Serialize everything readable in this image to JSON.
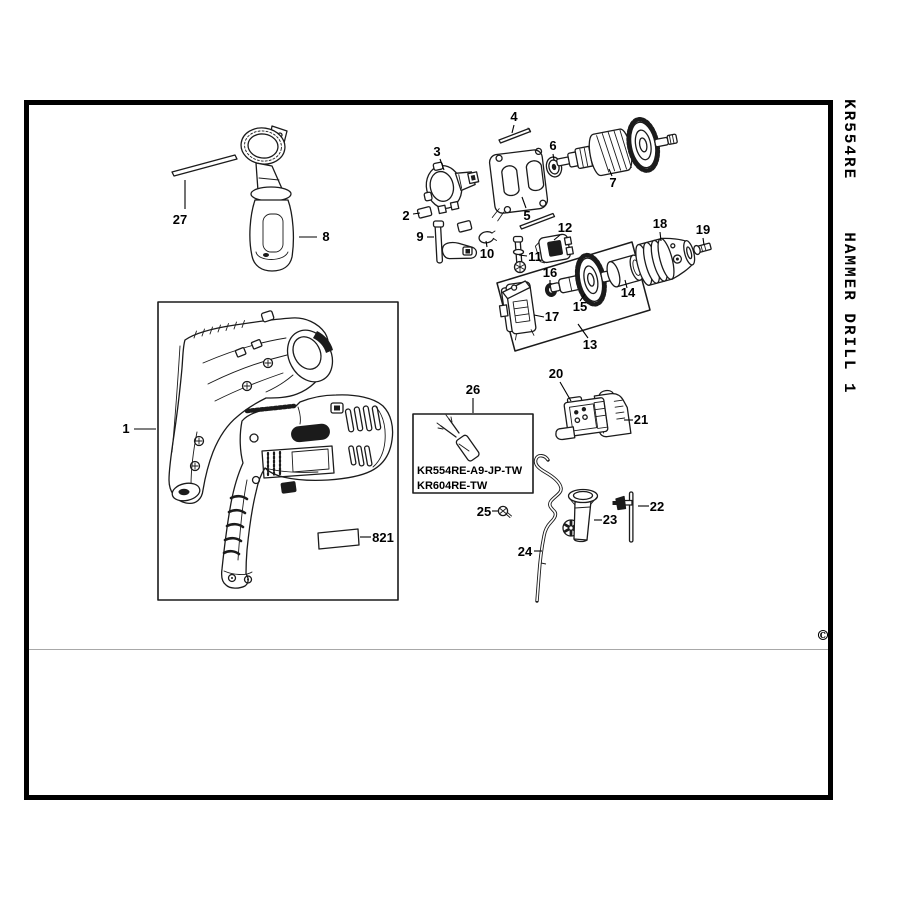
{
  "spine": {
    "model": "KR554RE",
    "product": "HAMMER DRILL 1"
  },
  "copyright_symbol": "©",
  "inset_box": {
    "line1": "KR554RE-A9-JP-TW",
    "line2": "KR604RE-TW"
  },
  "callouts": {
    "c1": "1",
    "c2": "2",
    "c3": "3",
    "c4": "4",
    "c5": "5",
    "c6": "6",
    "c7": "7",
    "c8": "8",
    "c9": "9",
    "c10": "10",
    "c11": "11",
    "c12": "12",
    "c13": "13",
    "c14": "14",
    "c15": "15",
    "c16": "16",
    "c17": "17",
    "c18": "18",
    "c19": "19",
    "c20": "20",
    "c21": "21",
    "c22": "22",
    "c23": "23",
    "c24": "24",
    "c25": "25",
    "c26": "26",
    "c27": "27",
    "c821": "821"
  }
}
